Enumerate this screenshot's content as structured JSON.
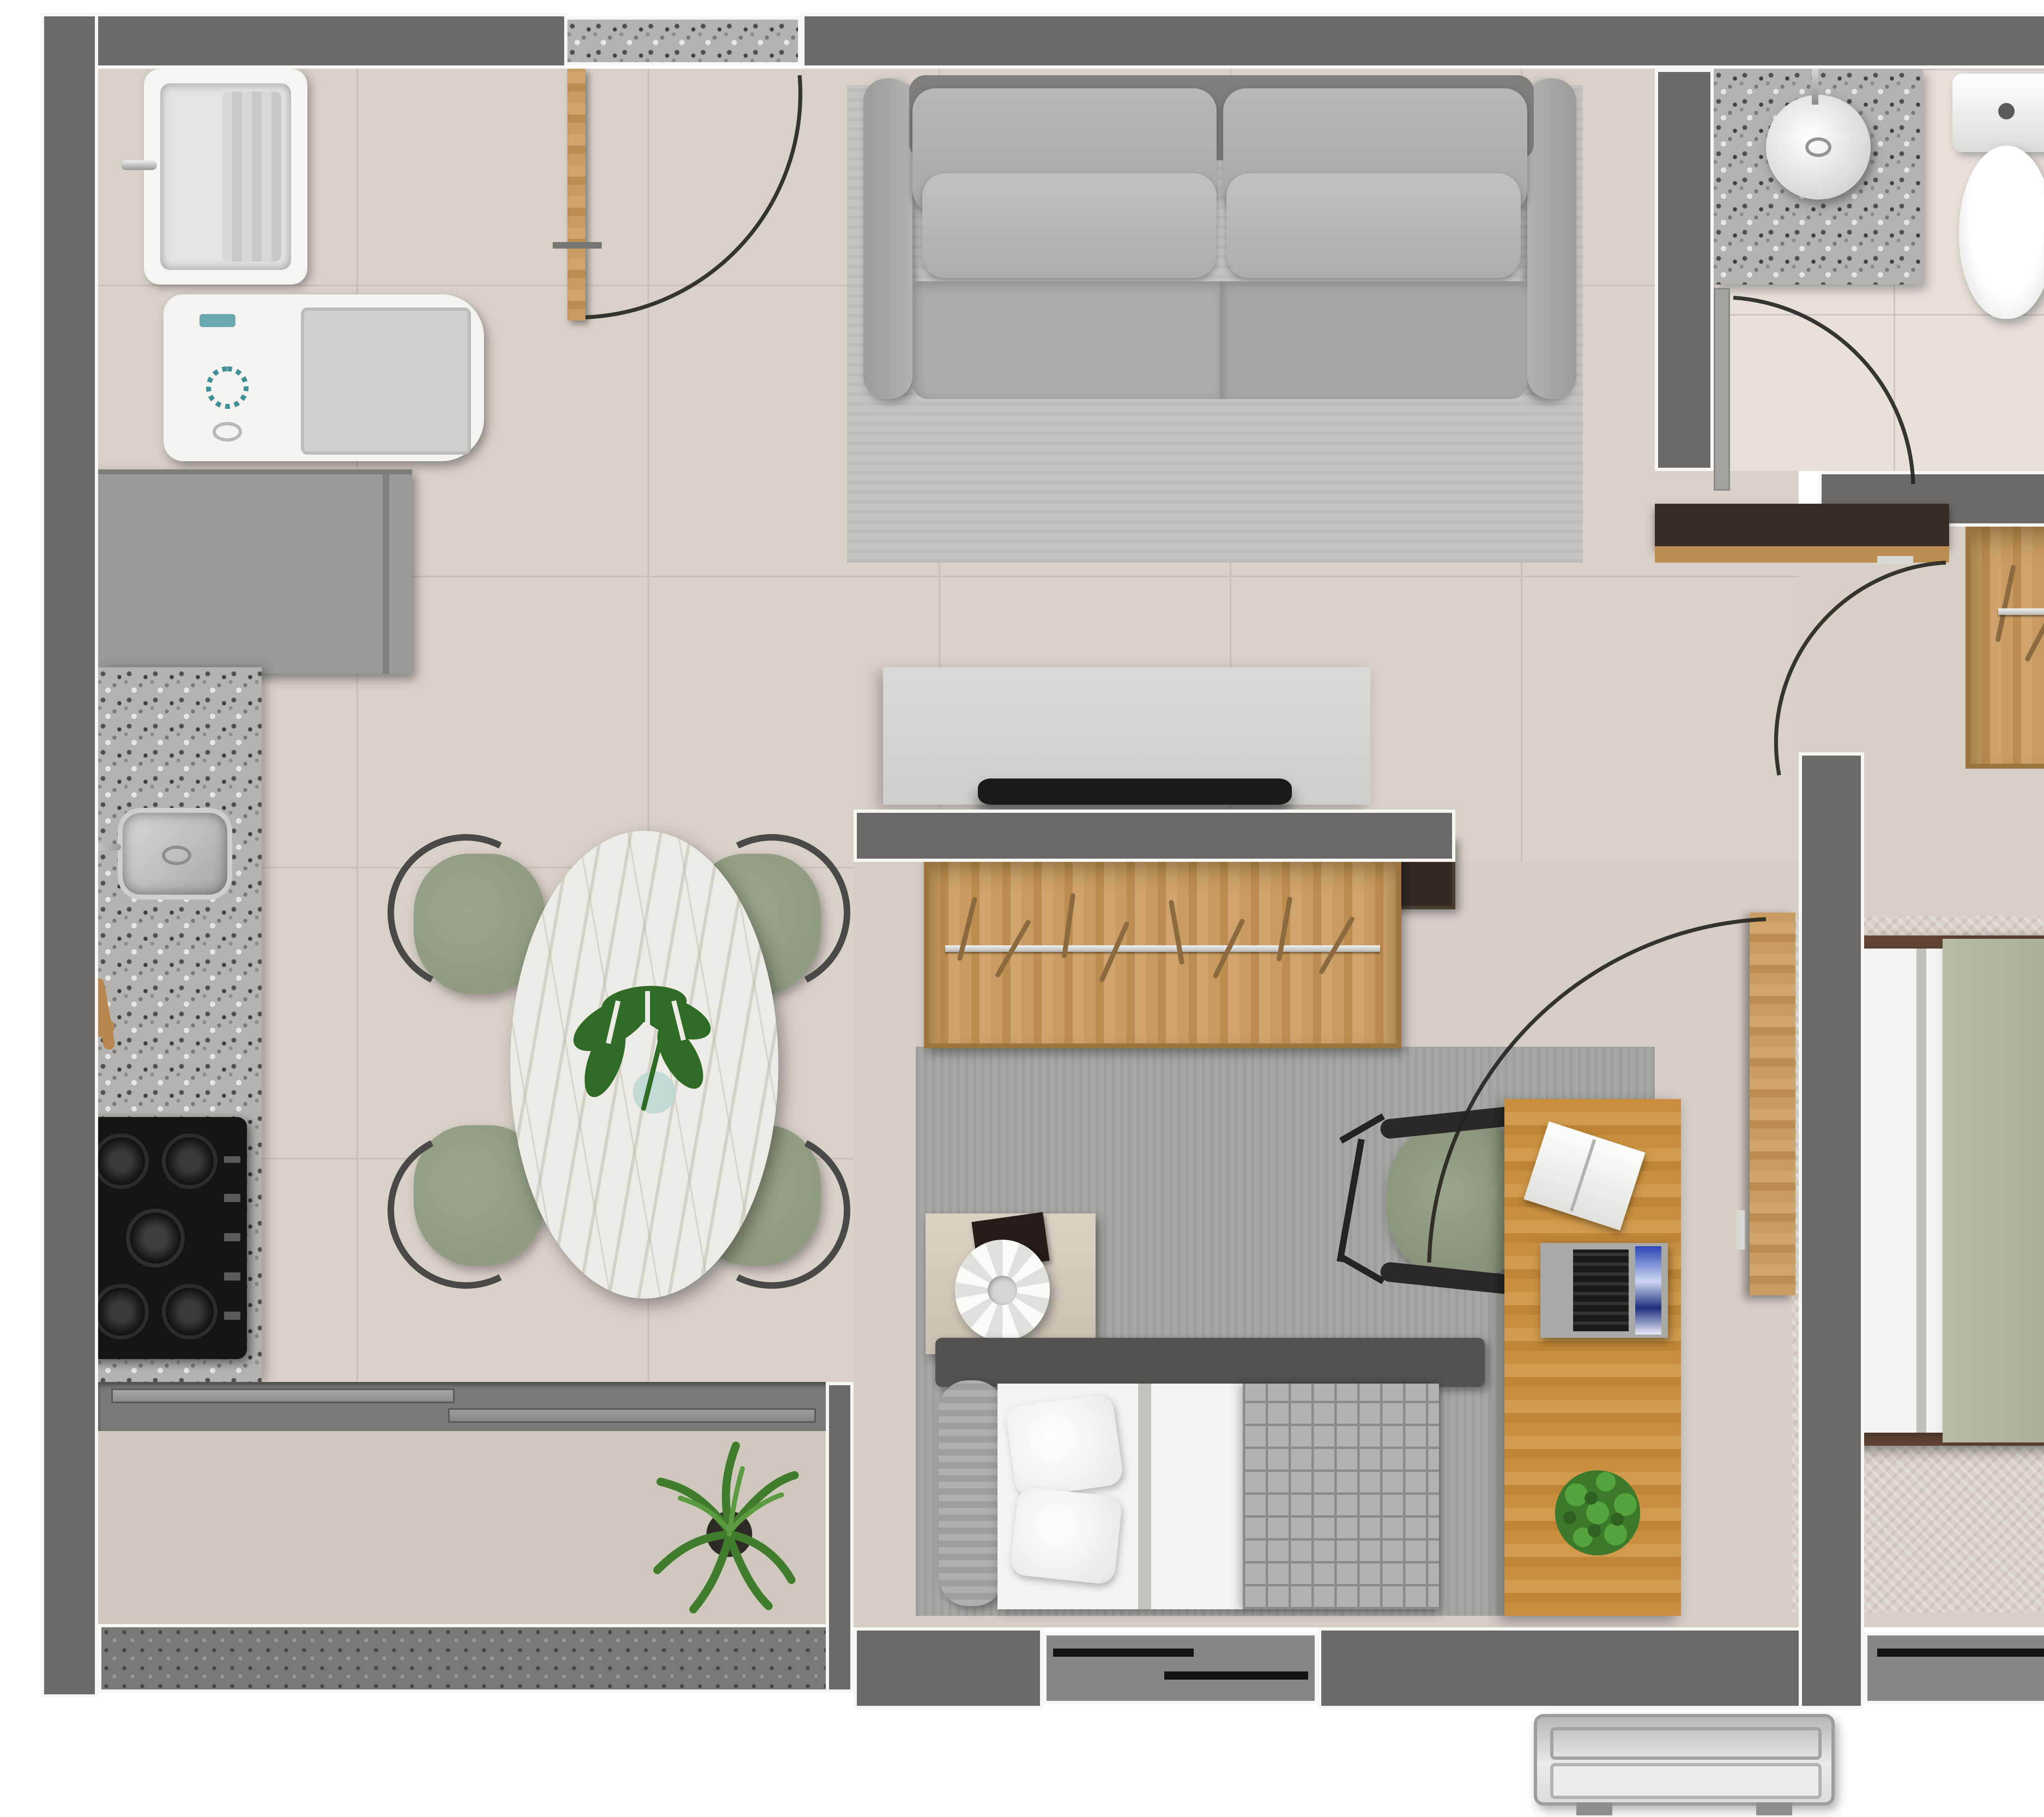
{
  "meta": {
    "title": "apartment-floor-plan-top-view",
    "view": "top-down 3d render",
    "text_content": "none"
  },
  "colors": {
    "background": "#ffffff",
    "wall": "#6c6965",
    "wall_outline": "#f7f6f3",
    "floor_main": "#d8d1c7",
    "floor_grout": "#c7c0b5",
    "floor_bedroom1": "#d9d0c5",
    "floor_bedroom2": "#d5cec5",
    "floor_bathroom": "#e7e1d8",
    "floor_balcony": "#cfc8bc",
    "granite": "#b5b2ad",
    "granite_dark": "#524f4a",
    "granite_light": "#eae8e4",
    "balcony_parapet": "#7c7974",
    "wood": "#c69a5e",
    "wood_dark": "#a97c41",
    "desk_wood": "#c38a44",
    "dark_door": "#3c322a",
    "sofa": "#aba9a5",
    "sofa_cushion": "#b8b6b2",
    "sofa_rug": "#c6c3bf",
    "bedroom2_rug": "#a9a7a4",
    "bedroom1_rug": "#d8d1c5",
    "bedding_white": "#f2f0ec",
    "sage_green": "#b6b8a1",
    "sage_dark": "#a0a489",
    "plaid_blanket": "#b3b1ac",
    "chair_green": "#8f9c81",
    "metal": "#4a4947",
    "marble": "#edebe5",
    "marble_vein": "#cfccc1",
    "tv_cabinet": "#d8d6d3",
    "tv": "#1b1a19",
    "appliance_white": "#f3f2ef",
    "appliance_gray": "#cdccc9",
    "refrigerator": "#9c9a96",
    "washer_accent_teal": "#3f9098",
    "window_frame": "#37342f",
    "window_glass": "#8a8782",
    "door_arc": "#25221e",
    "plant_green": "#4c8a35",
    "plant_dark_green": "#2f6b22",
    "eucalyptus": "#7e9273",
    "bed_frame_brown": "#5f4432"
  },
  "rooms": [
    {
      "name": "kitchen-laundry",
      "furniture": [
        "laundry-tank-sink",
        "washing-machine",
        "refrigerator",
        "granite-counter",
        "kitchen-sink",
        "faucet",
        "wooden-utensils",
        "gas-cooktop"
      ]
    },
    {
      "name": "dining-area",
      "furniture": [
        "oval-marble-table",
        "monstera-leaf-centerpiece",
        "vase",
        "dining-chair",
        "dining-chair",
        "dining-chair",
        "dining-chair"
      ]
    },
    {
      "name": "living-area",
      "furniture": [
        "two-seat-sofa",
        "back-cushions",
        "area-rug",
        "tv-console",
        "television",
        "wall-cabinet"
      ]
    },
    {
      "name": "entry",
      "furniture": [
        "entry-door",
        "granite-threshold"
      ]
    },
    {
      "name": "balcony",
      "furniture": [
        "sliding-glass-door",
        "potted-fern",
        "parapet"
      ]
    },
    {
      "name": "bathroom",
      "furniture": [
        "granite-vanity",
        "vessel-sink",
        "faucet",
        "toilet",
        "shower-hand-set",
        "glass-partition",
        "bathroom-door"
      ]
    },
    {
      "name": "bedroom-single",
      "furniture": [
        "open-wardrobe-with-hangers",
        "single-bed",
        "white-pillows",
        "plaid-blanket",
        "headboard",
        "nightstand",
        "flower-table-lamp",
        "decor-tray",
        "desk",
        "office-chair",
        "laptop",
        "open-notebook",
        "desk-plant",
        "gray-rug",
        "window",
        "wood-door"
      ]
    },
    {
      "name": "bedroom-double",
      "furniture": [
        "l-shaped-wardrobe-with-hangers",
        "double-bed",
        "sage-runner",
        "sage-pillows",
        "white-pillows",
        "bed-bench-tray",
        "eucalyptus-sprigs",
        "beige-rug",
        "window",
        "dark-door"
      ]
    },
    {
      "name": "exterior",
      "furniture": [
        "ac-condenser-unit"
      ]
    }
  ],
  "doors": [
    "entry-door-swing",
    "bathroom-door-swing",
    "bedroom-single-door-swing",
    "bedroom-double-door-swing"
  ]
}
